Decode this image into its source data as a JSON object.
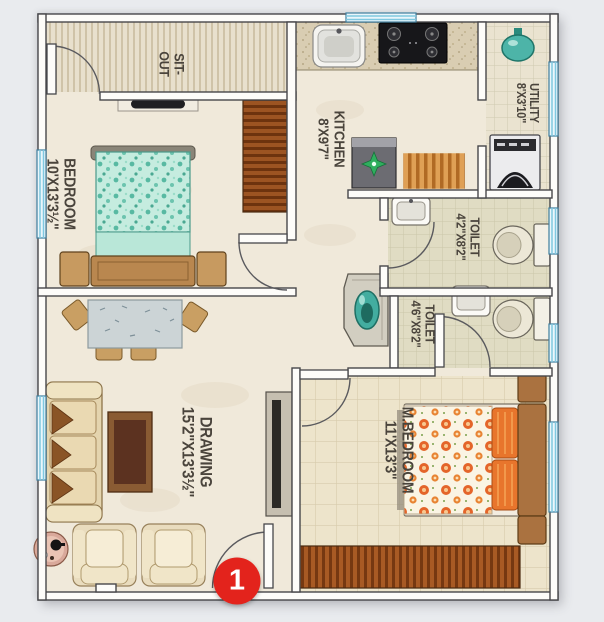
{
  "plan": {
    "background_color": "#e9ebee",
    "floor_color": "#f0e9da",
    "wall_outline_color": "#47474a",
    "window_color": "#7fc8e0",
    "rooms": {
      "sitout": {
        "lines": [
          "SIT-",
          "OUT"
        ]
      },
      "bedroom": {
        "lines": [
          "BEDROOM",
          "10'X13'3½\""
        ]
      },
      "kitchen": {
        "lines": [
          "KITCHEN",
          "8'X9'7\""
        ]
      },
      "utility": {
        "lines": [
          "UTILITY",
          "8'X3'10\""
        ]
      },
      "toilet_top": {
        "lines": [
          "TOILET",
          "4'2\"X8'2\""
        ]
      },
      "toilet_bottom": {
        "lines": [
          "TOILET",
          "4'6\"X8'2\""
        ]
      },
      "drawing": {
        "lines": [
          "DRAWING",
          "15'2\"X13'3½\""
        ]
      },
      "master_bedroom": {
        "lines": [
          "M.BEDROOM",
          "11'X13'3\""
        ]
      }
    },
    "entrance_marker": {
      "label": "1",
      "color": "#e3231c"
    }
  }
}
